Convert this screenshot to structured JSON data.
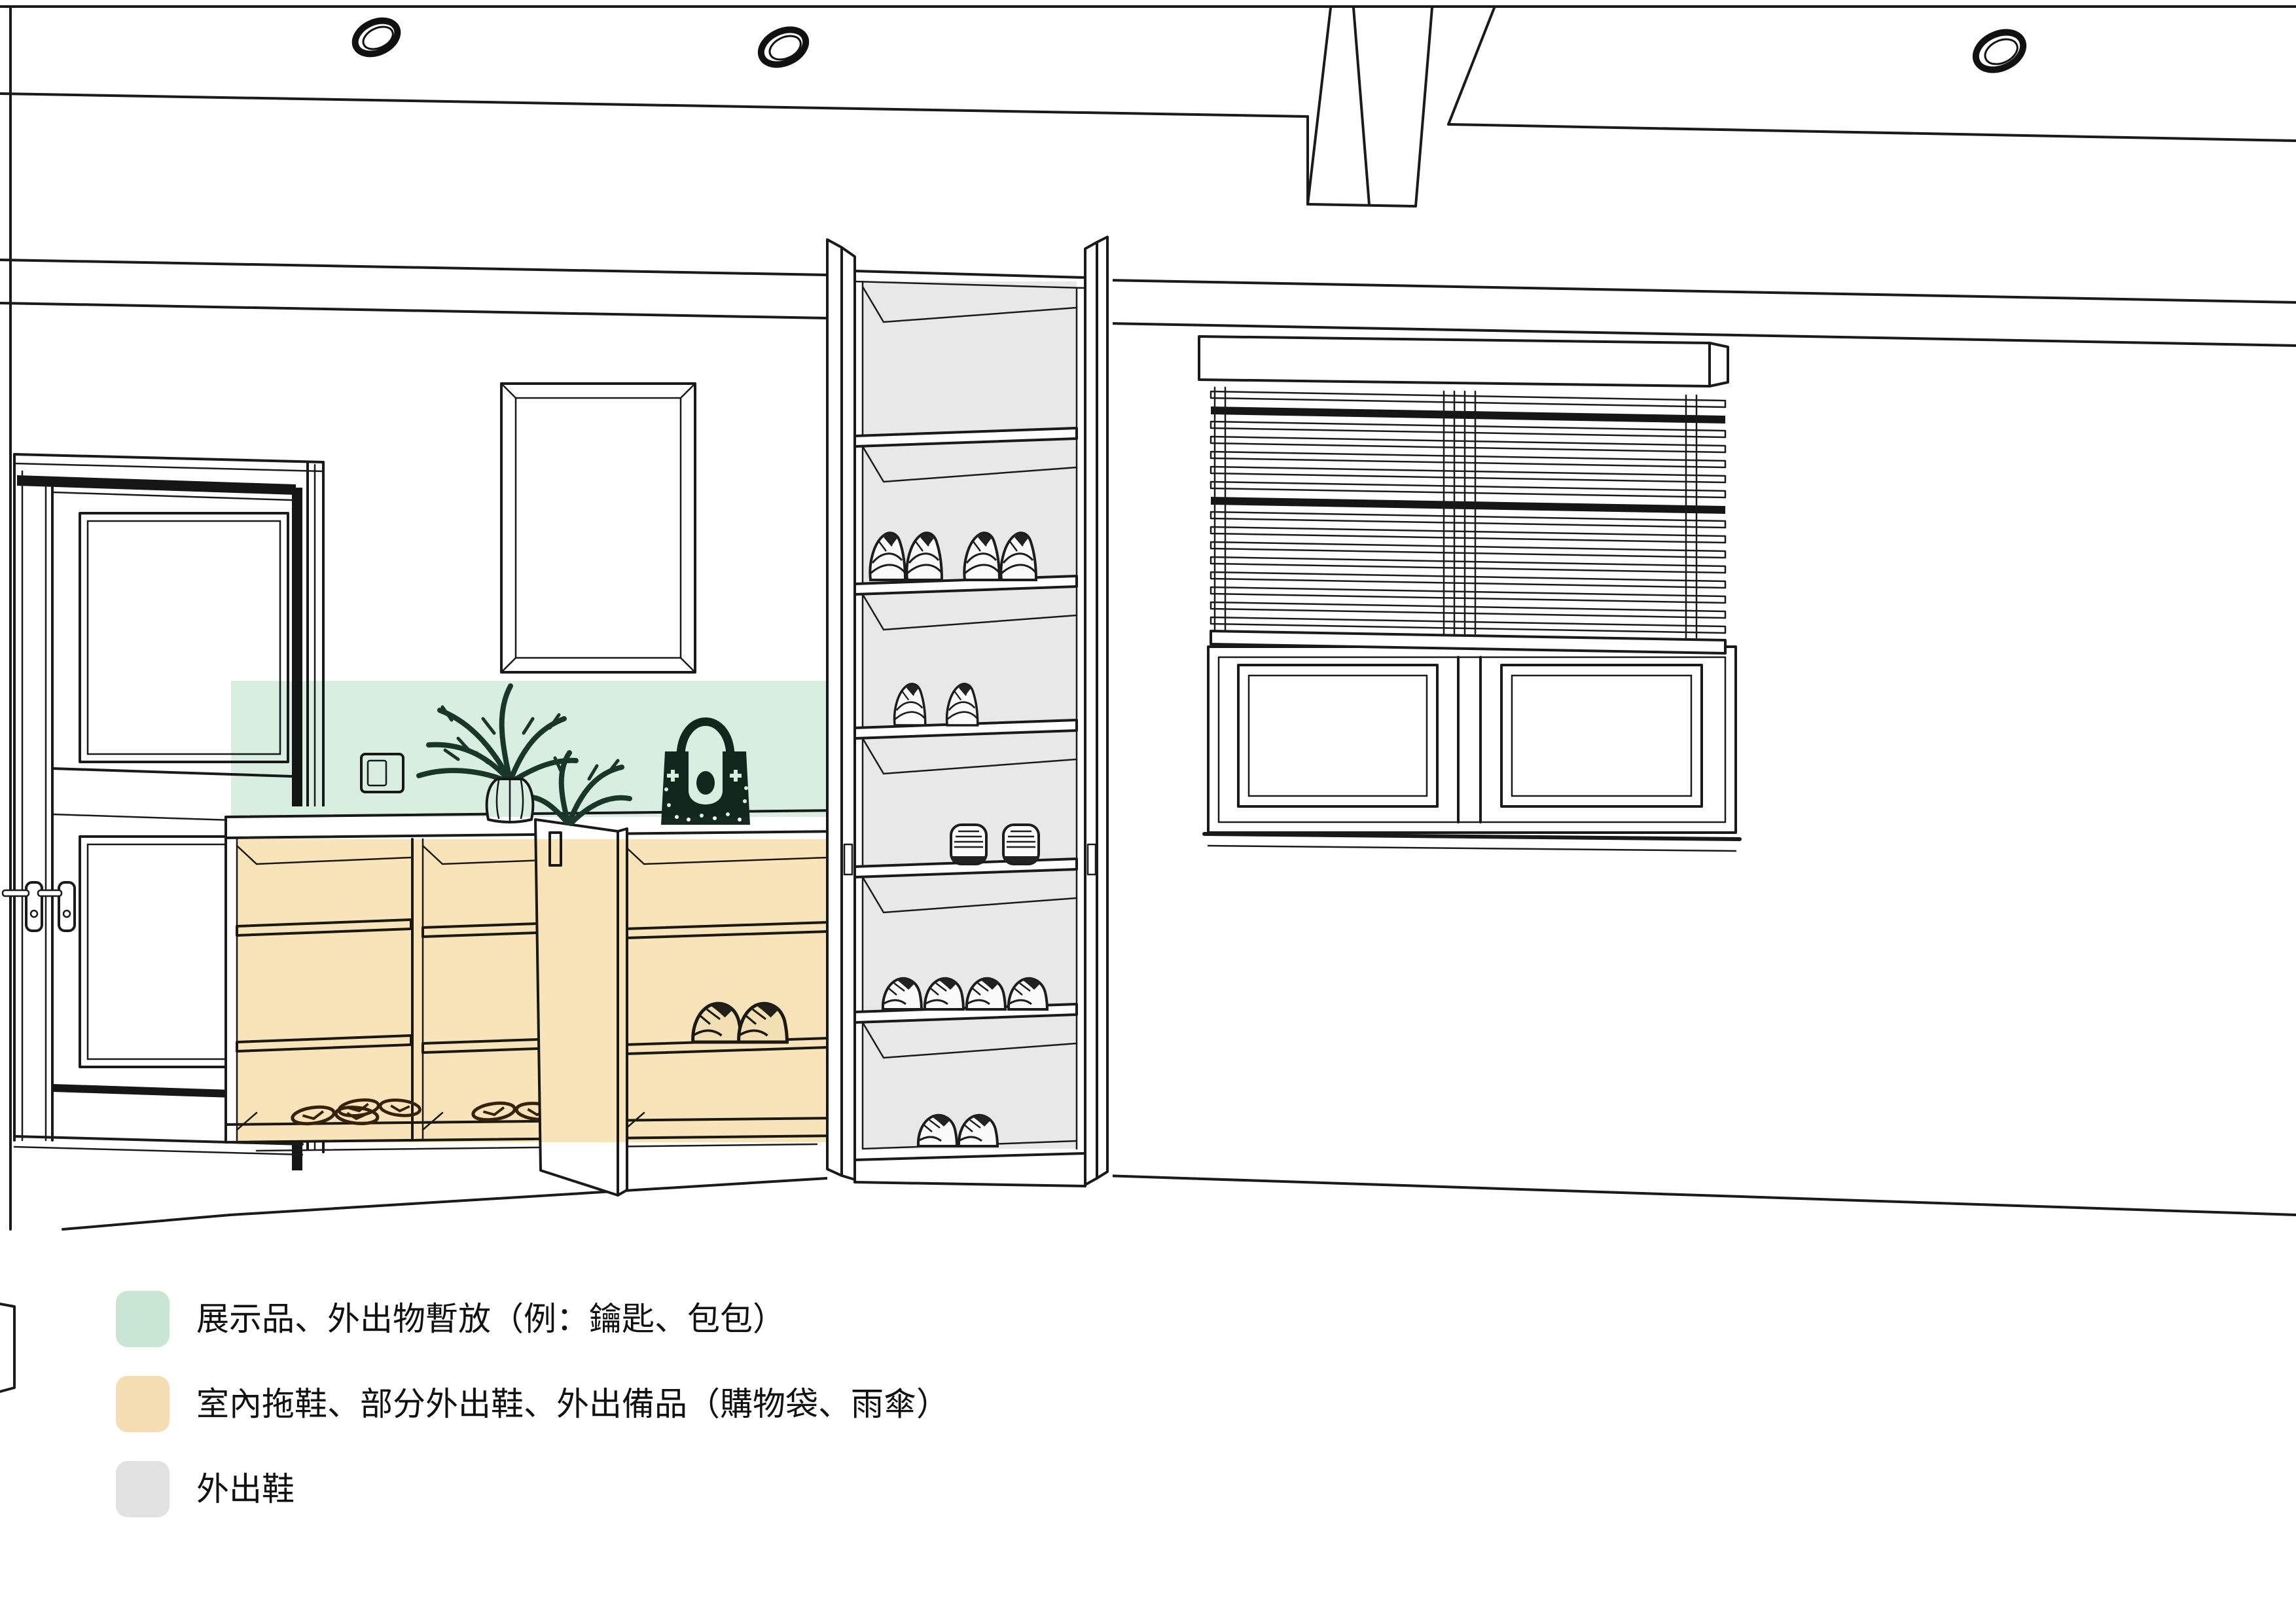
{
  "legend": {
    "items": [
      {
        "zone": "display-temporary-storage",
        "label": "展示品、外出物暫放（例：鑰匙、包包）",
        "color": "#c9e5d3"
      },
      {
        "zone": "indoor-slippers-outing-gear",
        "label": "室內拖鞋、部分外出鞋、外出備品（購物袋、雨傘）",
        "color": "#f4ddb0"
      },
      {
        "zone": "outdoor-shoes",
        "label": "外出鞋",
        "color": "#e2e2e2"
      }
    ]
  },
  "colors": {
    "background": "#ffffff",
    "line": "#1a1a1a",
    "green_zone": "#d8eee1",
    "orange_zone": "#f8e4b8",
    "cabinet_interior_gray": "#e8e8e8",
    "plant": "#1d3b2d",
    "bag": "#14291f",
    "slipper": "#39250f"
  },
  "scene": {
    "ceiling_lights_count": 3,
    "tall_cabinet_compartments": 6,
    "low_cabinet_sections": 3,
    "window_blind": "venetian",
    "entry_door_leaves": 2
  }
}
